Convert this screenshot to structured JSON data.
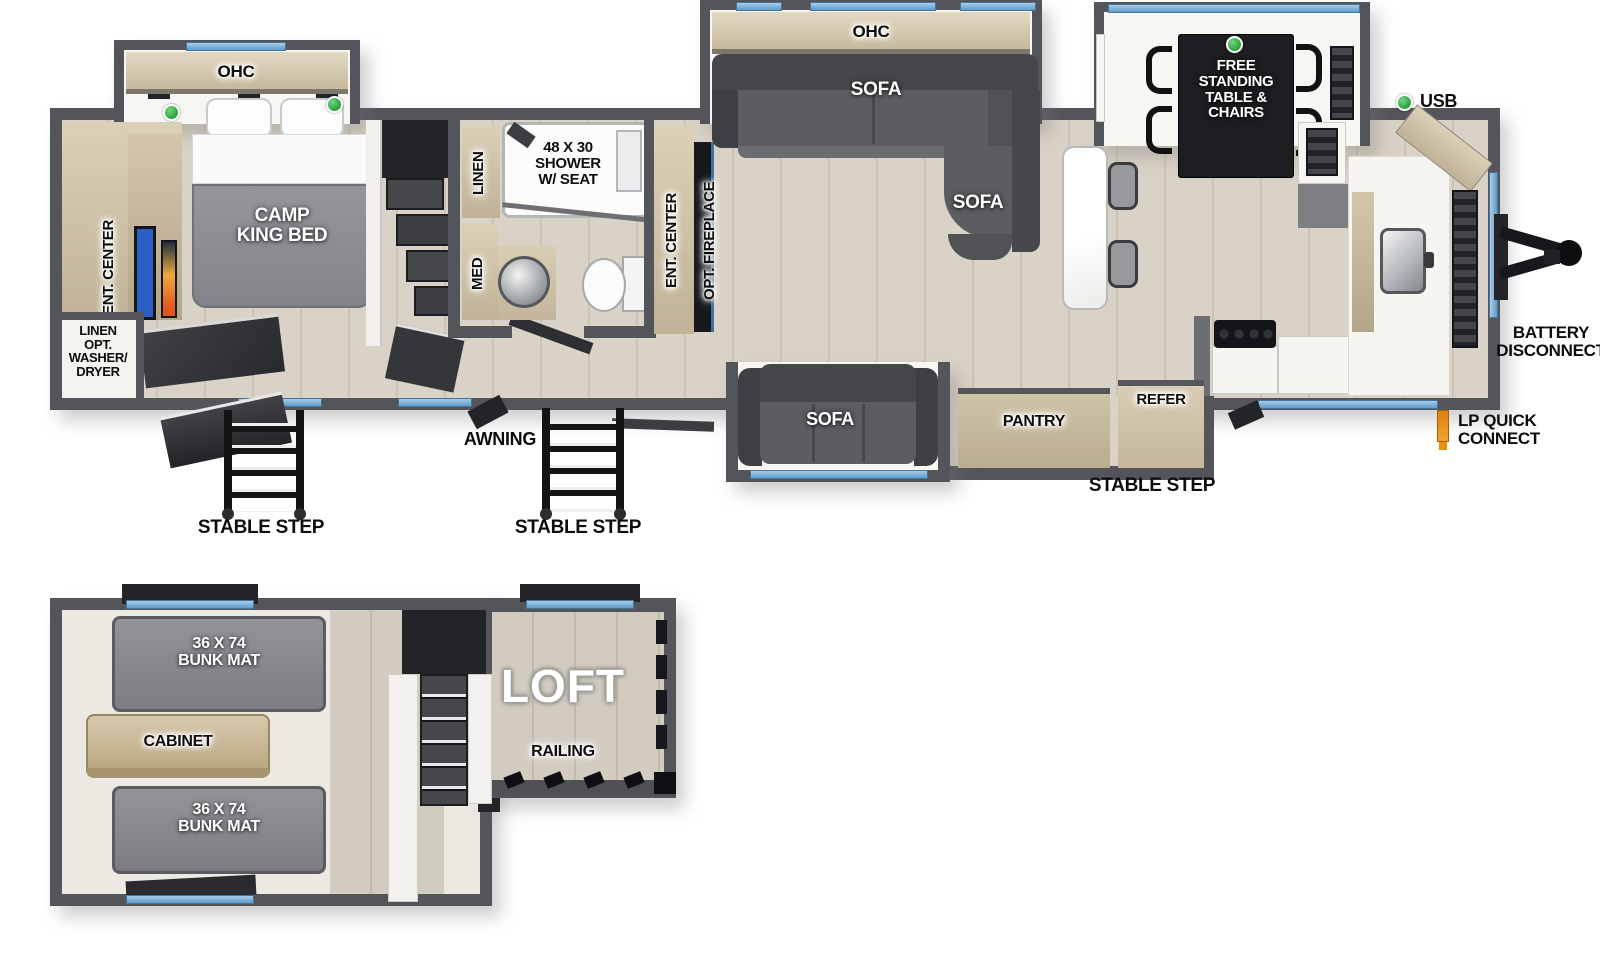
{
  "main_floor": {
    "bedroom": {
      "ohc_label": "OHC",
      "bed_label": "CAMP\nKING BED",
      "ent_center_label": "ENT. CENTER",
      "linen_washer_label": "LINEN\nOPT.\nWASHER/\nDRYER"
    },
    "bathroom": {
      "linen_label": "LINEN",
      "med_label": "MED",
      "shower_label": "48 X 30\nSHOWER\nW/ SEAT"
    },
    "living": {
      "ohc_label": "OHC",
      "sofa_label": "SOFA",
      "chaise_sofa_label": "SOFA",
      "slide_sofa_label": "SOFA",
      "ent_center_label": "ENT. CENTER",
      "fireplace_label": "OPT. FIREPLACE"
    },
    "dinette": {
      "table_label": "FREE\nSTANDING\nTABLE &\nCHAIRS"
    },
    "kitchen": {
      "pantry_label": "PANTRY",
      "refer_label": "REFER"
    },
    "callouts": {
      "stable_step_rear": "STABLE STEP",
      "stable_step_mid": "STABLE STEP",
      "stable_step_front": "STABLE STEP",
      "awning": "AWNING",
      "usb": "USB",
      "battery_disconnect": "BATTERY\nDISCONNECT",
      "lp_quick_connect": "LP QUICK\nCONNECT"
    }
  },
  "loft_floor": {
    "bunk_top_label": "36 X 74\nBUNK MAT",
    "bunk_bottom_label": "36 X 74\nBUNK MAT",
    "cabinet_label": "CABINET",
    "loft_label": "LOFT",
    "railing_label": "RAILING"
  },
  "colors": {
    "wall": "#54555a",
    "window_blue": "#7fb3d9",
    "indicator_green": "#2aa03c",
    "lp_orange": "#e8891f"
  }
}
